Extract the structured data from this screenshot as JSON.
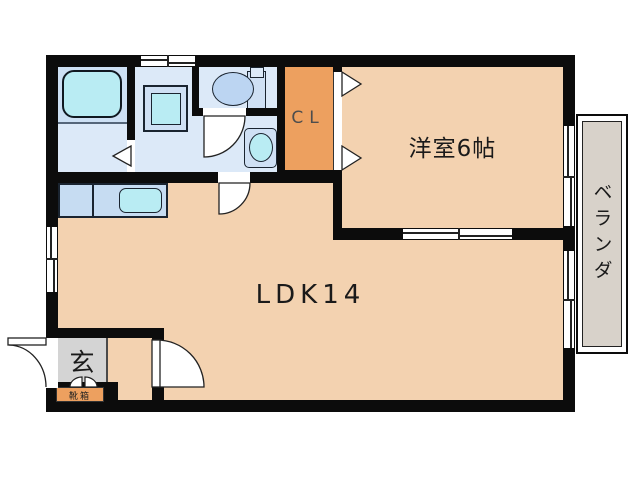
{
  "plan_type": "floor-plan",
  "rooms": {
    "ldk": {
      "label": "LDK14"
    },
    "western_room": {
      "label": "洋室6帖"
    },
    "closet": {
      "label": "CL"
    },
    "entrance": {
      "label": "玄"
    },
    "shoe_cabinet": {
      "label": "靴箱"
    },
    "veranda": {
      "label": "ベランダ"
    }
  },
  "icons": {
    "bathtub-icon": "rounded-rect basin",
    "washing-machine-pan-icon": "nested squares",
    "toilet-icon": "tank with oval bowl",
    "vanity-sink-icon": "rounded square with oval basin",
    "kitchen-counter-icon": "rect counter with rounded sink",
    "door-swing-icon": "quarter-circle arc",
    "folding-door-icon": "triangle arrow",
    "sliding-window-icon": "double offset lines with center tick",
    "shoe-cabinet-doors-icon": "double quarter arcs"
  },
  "colors": {
    "wall": "#0c0c0c",
    "floor_peach": "#f3d2b0",
    "closet_orange": "#eda05f",
    "wet_room_blue": "#dce9f8",
    "bath_upper_blue": "#cde0f4",
    "fixture_blue": "#cfe0f4",
    "counter_blue": "#c6dcf2",
    "fixture_cyan": "#b9ecf3",
    "toilet_bowl_blue": "#bcd5f2",
    "entrance_gray": "#d4d4d4",
    "veranda_gray": "#d8d2ca",
    "line_dark": "#222222",
    "bg": "#ffffff"
  }
}
